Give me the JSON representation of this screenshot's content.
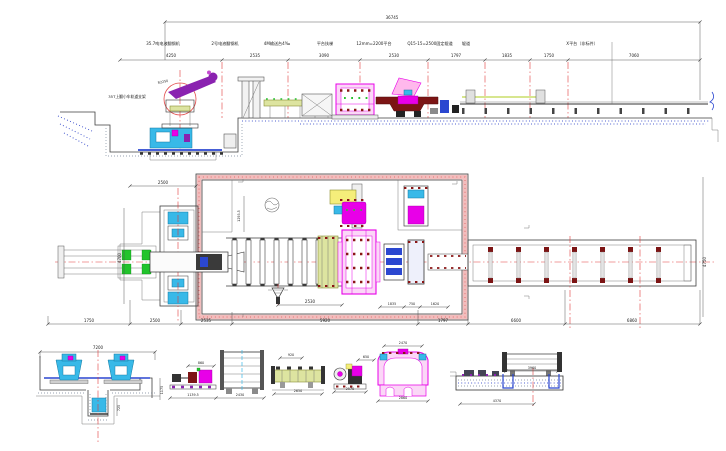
{
  "elevation": {
    "total_dim": "36745",
    "labels": [
      "35.7吨电液翻钢机",
      "2号电液翻钢机",
      "4M输送台4‰",
      "平台扶梯",
      "12mm=2200平台",
      "Q15-15=2500固定辊道",
      "辊道",
      "X平台（非标件）"
    ],
    "dims": [
      "4250",
      "2535",
      "3090",
      "2530",
      "1797",
      "1835",
      "1750",
      "7060"
    ],
    "left_label": "35T上翻小车轨道支架",
    "circle_label": "R2250"
  },
  "plan": {
    "dims_bottom": [
      "1750",
      "2500",
      "2535",
      "5920",
      "1797",
      "6600",
      "6860"
    ],
    "dim_top_left": "2500",
    "dim_center": "2530",
    "dim_rotated": "1293.5",
    "dim_v_left": "4700",
    "dim_v_right": "4750",
    "sub_dims": [
      "1835",
      "750",
      "1620"
    ]
  },
  "details": {
    "d1": {
      "top": "7200",
      "side": "1175",
      "sub": "725"
    },
    "d2": {
      "top": "860",
      "left": "1139.5",
      "right": "2430"
    },
    "d3": {
      "top": "920",
      "bottom": "2650"
    },
    "d4": {
      "top": "650",
      "bottom": "2570"
    },
    "d5": {
      "top": "2470",
      "bottom": "2860"
    },
    "d6": {
      "top": "3960",
      "bottom": "4370"
    }
  }
}
